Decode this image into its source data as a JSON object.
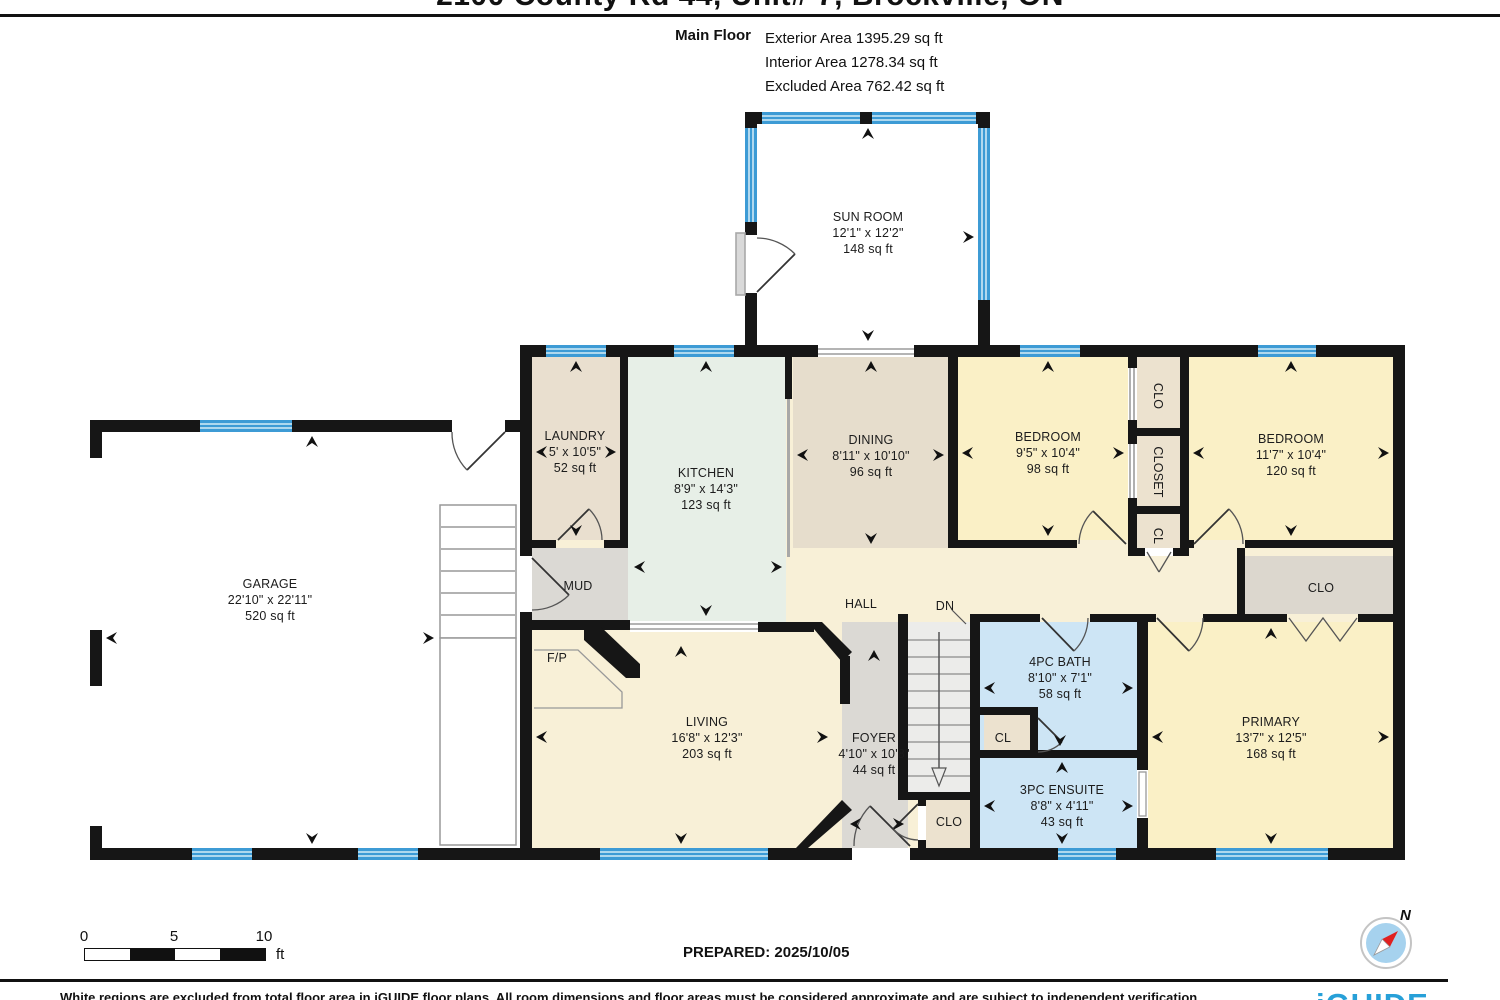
{
  "header": {
    "title": "2100 County Rd 44, Unit# 7, Brockville, ON",
    "floor_label": "Main Floor",
    "stats": [
      {
        "label": "Exterior Area",
        "value": "1395.29 sq ft"
      },
      {
        "label": "Interior Area",
        "value": "1278.34 sq ft"
      },
      {
        "label": "Excluded Area",
        "value": "762.42 sq ft"
      }
    ]
  },
  "rooms": [
    {
      "id": "sun-room",
      "name": "SUN ROOM",
      "dim": "12'1\" x 12'2\"",
      "area": "148 sq ft"
    },
    {
      "id": "garage",
      "name": "GARAGE",
      "dim": "22'10\" x 22'11\"",
      "area": "520 sq ft"
    },
    {
      "id": "laundry",
      "name": "LAUNDRY",
      "dim": "5' x 10'5\"",
      "area": "52 sq ft"
    },
    {
      "id": "kitchen",
      "name": "KITCHEN",
      "dim": "8'9\" x 14'3\"",
      "area": "123 sq ft"
    },
    {
      "id": "dining",
      "name": "DINING",
      "dim": "8'11\" x 10'10\"",
      "area": "96 sq ft"
    },
    {
      "id": "bedroom-1",
      "name": "BEDROOM",
      "dim": "9'5\" x 10'4\"",
      "area": "98 sq ft"
    },
    {
      "id": "bedroom-2",
      "name": "BEDROOM",
      "dim": "11'7\" x 10'4\"",
      "area": "120 sq ft"
    },
    {
      "id": "living",
      "name": "LIVING",
      "dim": "16'8\" x 12'3\"",
      "area": "203 sq ft"
    },
    {
      "id": "foyer",
      "name": "FOYER",
      "dim": "4'10\" x 10'8\"",
      "area": "44 sq ft"
    },
    {
      "id": "bath-4pc",
      "name": "4PC BATH",
      "dim": "8'10\" x 7'1\"",
      "area": "58 sq ft"
    },
    {
      "id": "ensuite-3pc",
      "name": "3PC ENSUITE",
      "dim": "8'8\" x 4'11\"",
      "area": "43 sq ft"
    },
    {
      "id": "primary",
      "name": "PRIMARY",
      "dim": "13'7\" x 12'5\"",
      "area": "168 sq ft"
    },
    {
      "id": "mud",
      "name": "MUD"
    },
    {
      "id": "hall",
      "name": "HALL"
    },
    {
      "id": "dn",
      "name": "DN"
    },
    {
      "id": "fp",
      "name": "F/P"
    },
    {
      "id": "clo-top",
      "name": "CLO"
    },
    {
      "id": "closet-mid",
      "name": "CLOSET"
    },
    {
      "id": "cl-mid",
      "name": "CL"
    },
    {
      "id": "clo-right",
      "name": "CLO"
    },
    {
      "id": "cl-bath",
      "name": "CL"
    },
    {
      "id": "clo-foyer",
      "name": "CLO"
    }
  ],
  "footer": {
    "scale": {
      "ticks": [
        "0",
        "5",
        "10"
      ],
      "unit": "ft"
    },
    "prepared": "PREPARED: 2025/10/05",
    "compass_north": "N",
    "disclaimer": "White regions are excluded from total floor area in iGUIDE floor plans. All room dimensions and floor areas must be considered approximate and are subject to independent verification.",
    "brand": "iGUIDE"
  },
  "colors": {
    "window_blue": "#3d9bd5",
    "wall_black": "#161616",
    "bath_blue": "#cde5f5",
    "bedroom_yellow": "#faf0c6",
    "hall_cream": "#f8f0d7",
    "dining_tan": "#e6ddcc",
    "kitchen_mint": "#e7efe7",
    "gray_room": "#dbd9d4",
    "closet_beige": "#ece2cf",
    "brand_blue": "#27a0d8"
  }
}
